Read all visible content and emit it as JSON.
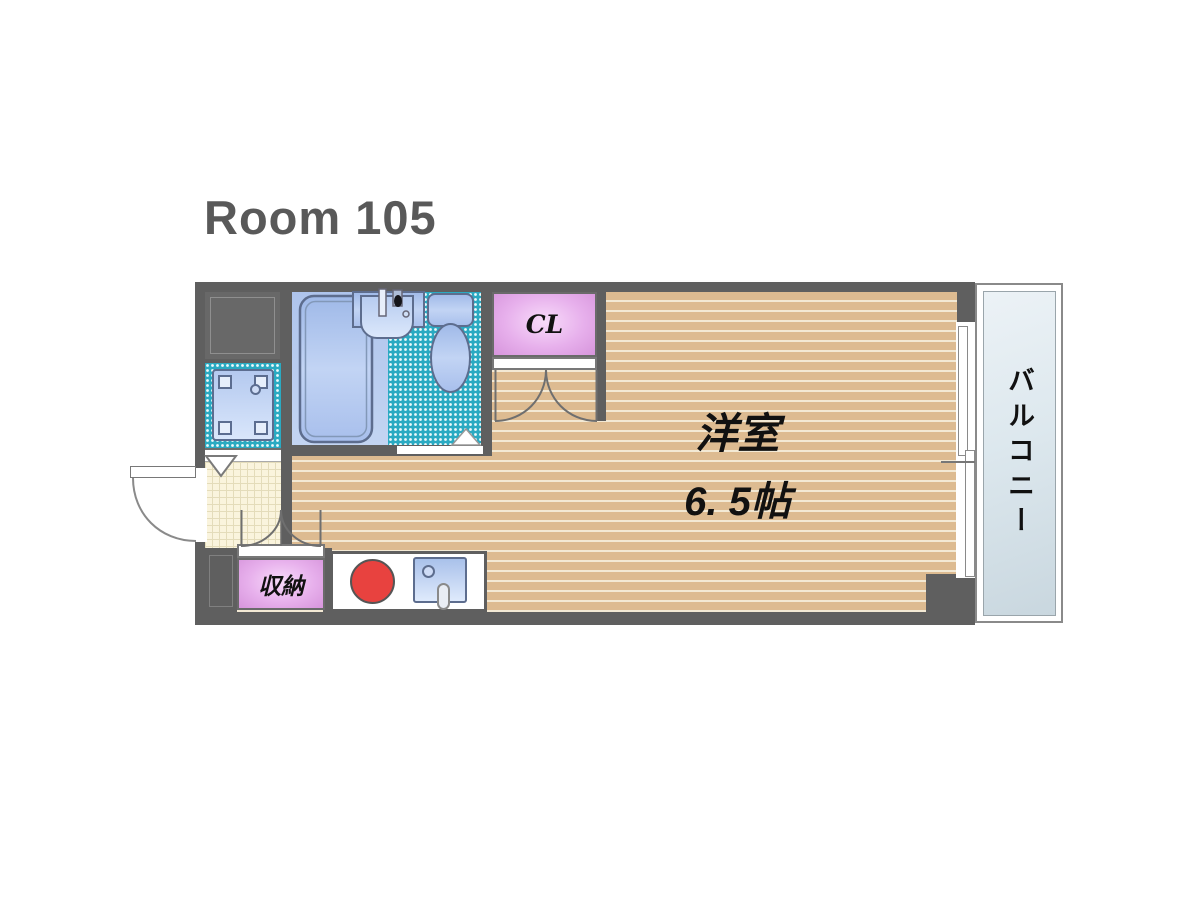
{
  "title": "Room 105",
  "plan": {
    "room_label": "洋室",
    "room_size": "6. 5帖",
    "closet_label": "CL",
    "storage_label": "収納",
    "balcony_label": "バルコニー",
    "colors": {
      "wall_gray": "#5f5f5f",
      "title_gray": "#595959",
      "floor_tan": "#ddbb91",
      "floor_stripe": "#f3e9d4",
      "tile_teal": "#2aaac2",
      "bath_blue": "#aec4ec",
      "fixture_blue": "#9fb9e8",
      "closet_pink": "#e7b0ec",
      "burner_red": "#e8423f",
      "genkan_cream": "#faf4dd",
      "balcony_blue_gray": "#dde8ee"
    }
  }
}
